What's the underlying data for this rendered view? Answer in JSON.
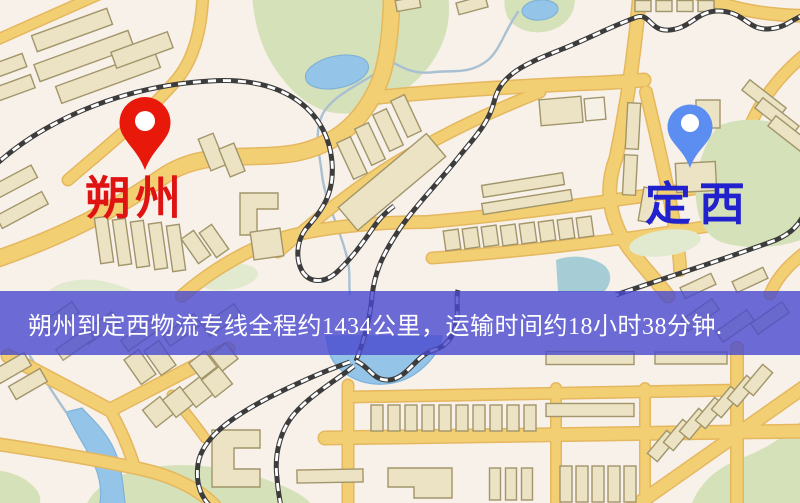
{
  "banner": {
    "text": "朔州到定西物流专线全程约1434公里，运输时间约18小时38分钟."
  },
  "markers": [
    {
      "id": "shuozhou",
      "label": "朔州",
      "pin_color": "#e8190b",
      "label_color": "#df1312",
      "x": 145,
      "y": 170
    },
    {
      "id": "dingxi",
      "label": "定西",
      "pin_color": "#5c8ef2",
      "label_color": "#2121cd",
      "x": 690,
      "y": 168
    }
  ],
  "map": {
    "palette": {
      "bg": "#f7f1ea",
      "road": "#f3cf74",
      "road_casing": "#e5b75e",
      "building": "#ebe3c4",
      "building_stroke": "#a2956a",
      "building_light": "#f6f1e7",
      "park": "#d5e1b8",
      "park_pale": "#e1eacf",
      "water": "#94c4e8",
      "water_stroke": "#7fb2d8",
      "stream": "#a9c0d2",
      "teal": "#a6cdd6",
      "rail_dark": "#3c3c3c",
      "rail_light": "#ffffff",
      "banner_bg": "rgba(72,72,206,0.8)",
      "banner_text": "#ffffff"
    }
  }
}
